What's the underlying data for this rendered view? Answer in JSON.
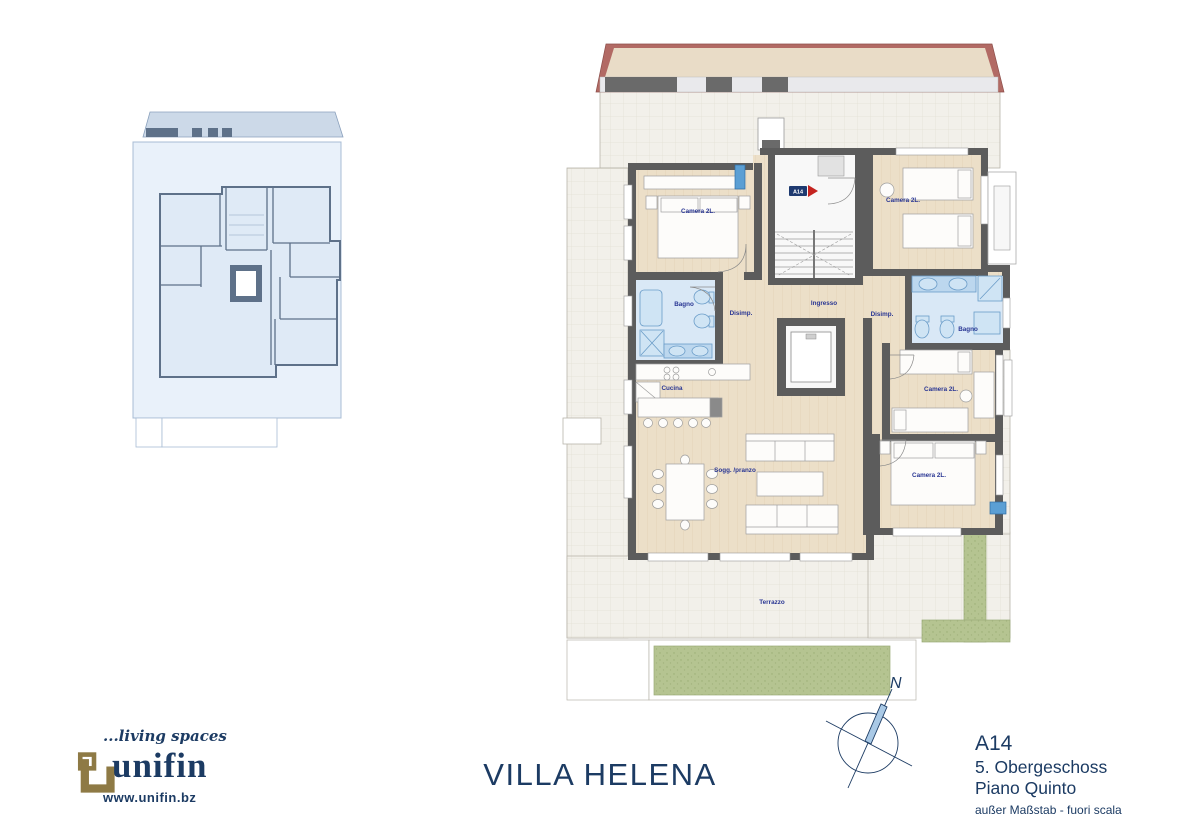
{
  "brand": {
    "tagline": "...living spaces",
    "name": "unifin",
    "website": "www.unifin.bz"
  },
  "title_block": {
    "project": "VILLA HELENA",
    "unit": "A14",
    "floor_de": "5. Obergeschoss",
    "floor_it": "Piano Quinto",
    "scale_note": "außer Maßstab - fuori scala"
  },
  "compass": {
    "north": "N"
  },
  "plan": {
    "entry_badge": "A14",
    "rooms": {
      "camera_tl": "Camera 2L.",
      "camera_tr": "Camera 2L.",
      "camera_mr": "Camera 2L.",
      "camera_br": "Camera 2L.",
      "bagno_left": "Bagno",
      "bagno_right": "Bagno",
      "cucina": "Cucina",
      "soggiorno": "Sogg. /pranzo",
      "ingresso": "Ingresso",
      "disimp_left": "Disimp.",
      "disimp_right": "Disimp.",
      "terrazzo": "Terrazzo"
    }
  },
  "colors": {
    "navy": "#1c3b63",
    "label_blue": "#283593",
    "roof_red": "#b26a64",
    "wall_gray": "#5c5c5c",
    "gold": "#8e7a45",
    "terrace": "#f2f0ea",
    "wood": "#ecdfc8",
    "bath_blue": "#d9e8f6",
    "green": "#b5c491"
  }
}
